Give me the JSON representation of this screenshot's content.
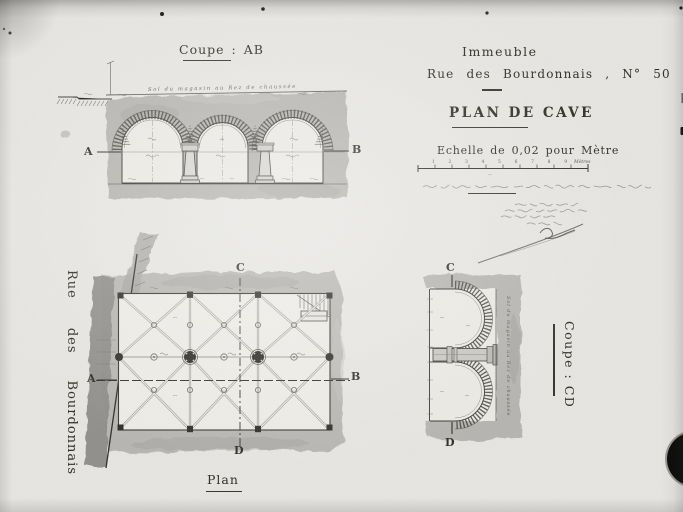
{
  "title_block": {
    "building": "Immeuble",
    "address": "Rue des Bourdonnais , N° 50 .",
    "title": "PLAN DE CAVE",
    "scale": "Echelle de 0,02 pour Mètre",
    "scale_numbers": "1 2 3 4 5 6 7 8 9",
    "scale_unit": "Mètres"
  },
  "views": {
    "section_ab": {
      "label": "Coupe : AB",
      "marker_a": "A",
      "marker_b": "B",
      "ground_note": "Sol du magasin au Rez de chaussée"
    },
    "plan": {
      "label": "Plan",
      "marker_a": "A",
      "marker_b": "B",
      "marker_c": "C",
      "marker_d": "D"
    },
    "section_cd": {
      "label": "Coupe : CD",
      "marker_c": "C",
      "marker_d": "D",
      "ground_note": "Sol du magasin au Rez de chaussée"
    },
    "street": {
      "word1": "Rue",
      "word2": "des",
      "word3": "Bourdonnais"
    }
  },
  "colors": {
    "paper": "#e6e5e1",
    "ink": "#33312a",
    "wall_wash": "#b2b1ad",
    "street_wall": "#8e8d89",
    "handwriting": "#6f6e69",
    "artifact_black": "#0c0c0c"
  }
}
